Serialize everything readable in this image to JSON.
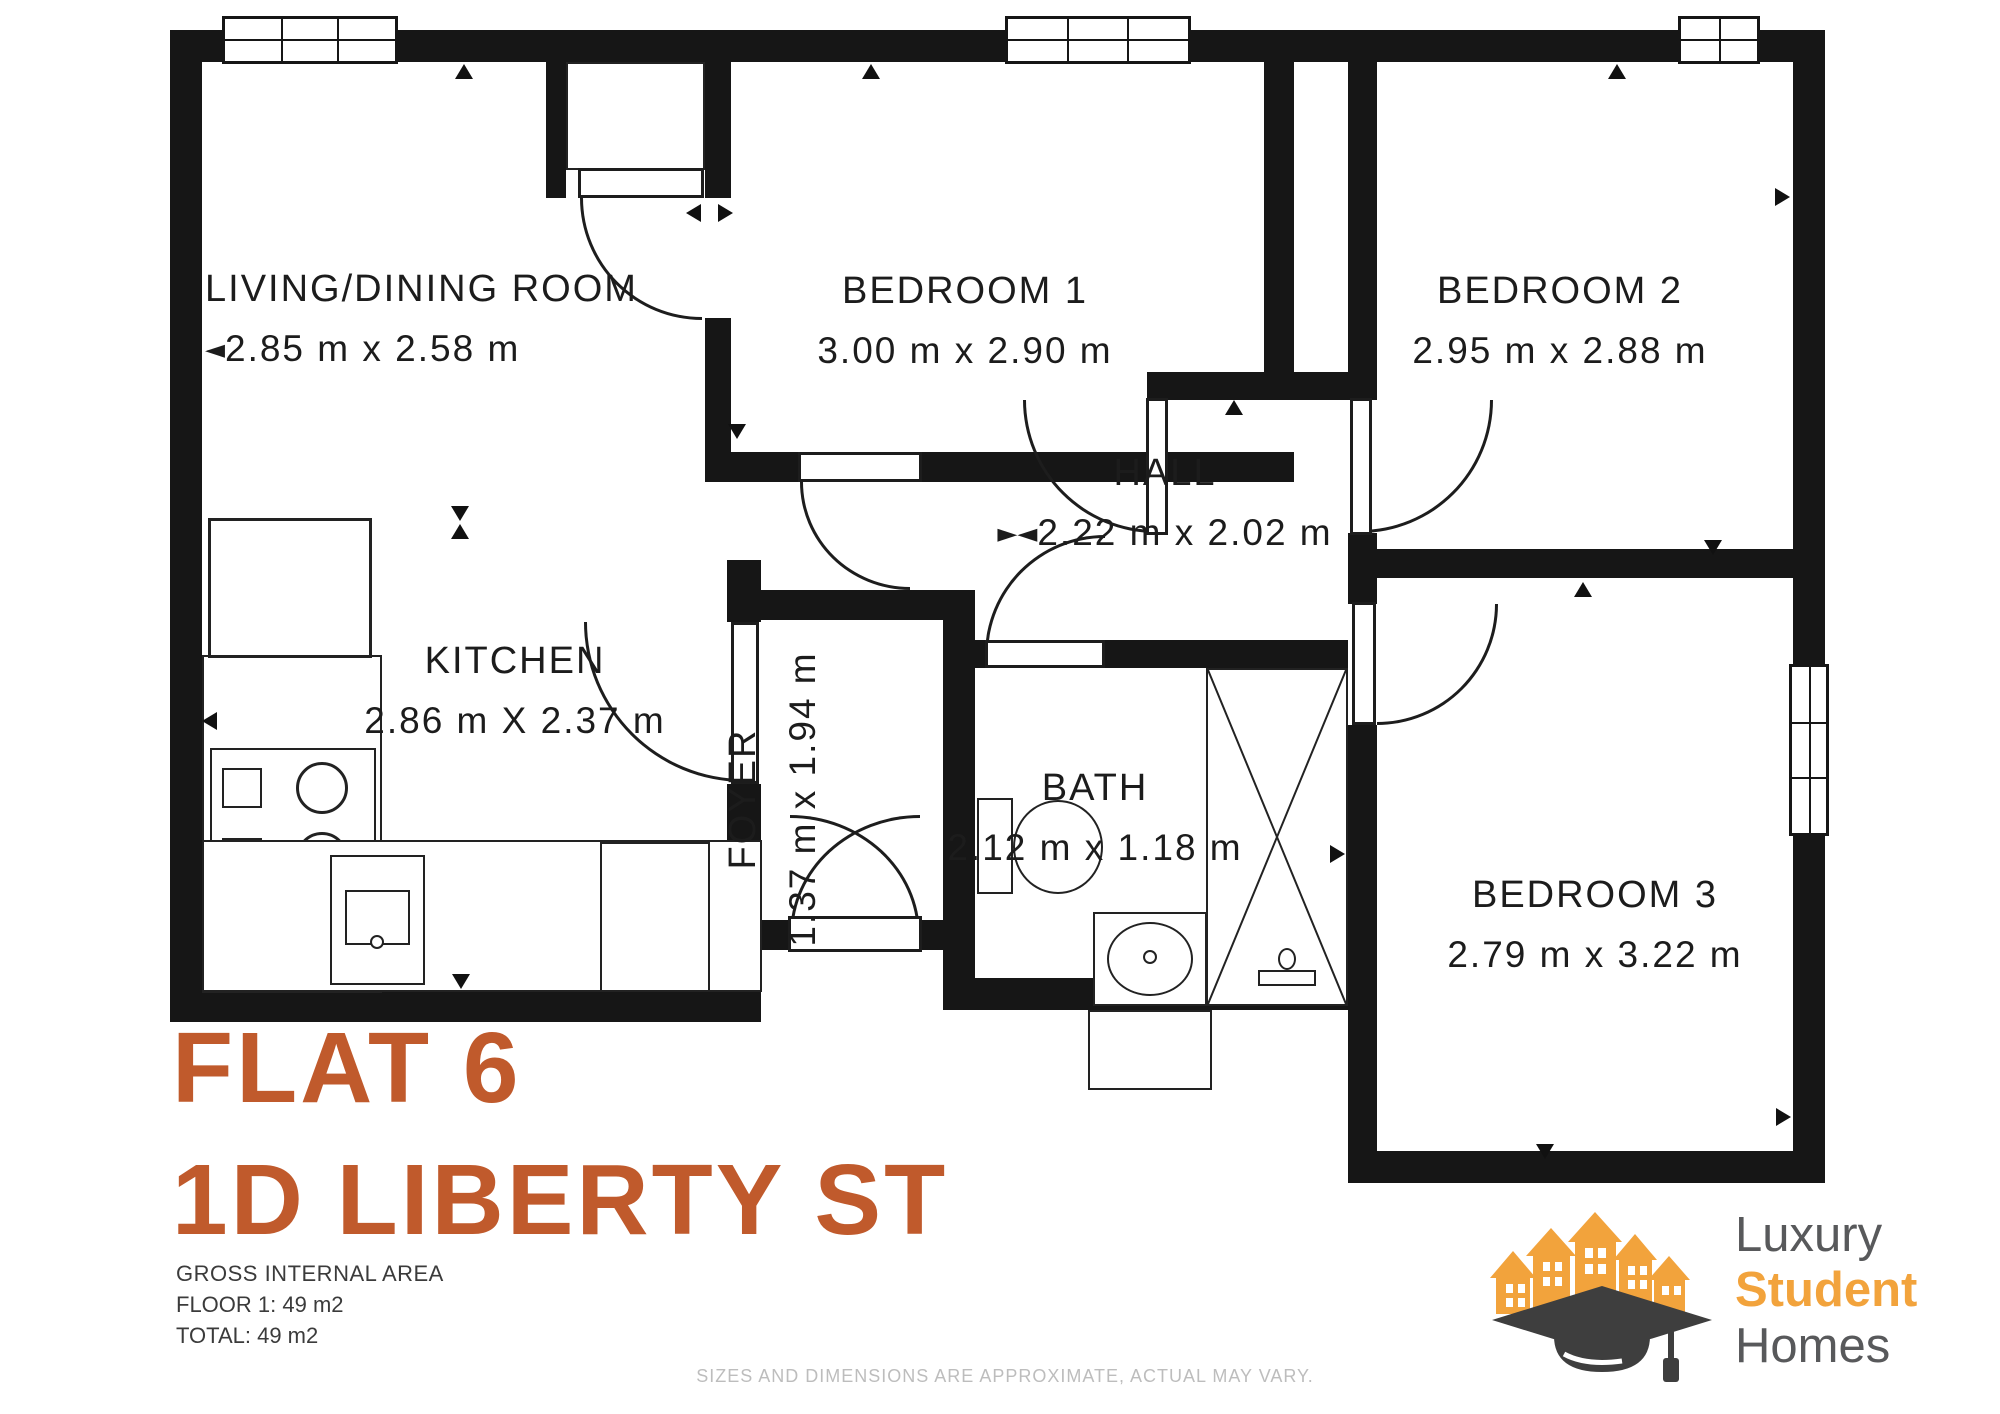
{
  "plan": {
    "rooms": [
      {
        "name": "LIVING/DINING ROOM",
        "dims": "2.85 m x 2.58 m",
        "marker": "◄"
      },
      {
        "name": "BEDROOM 1",
        "dims": "3.00 m x 2.90 m",
        "marker": ""
      },
      {
        "name": "BEDROOM 2",
        "dims": "2.95 m x 2.88 m",
        "marker": ""
      },
      {
        "name": "KITCHEN",
        "dims": "2.86 m X 2.37 m",
        "marker": ""
      },
      {
        "name": "FOYER",
        "dims": "1.37 m x 1.94 m",
        "marker": ""
      },
      {
        "name": "HALL",
        "dims": "2.22 m x 2.02 m",
        "marker": "►◄"
      },
      {
        "name": "BATH",
        "dims": "2.12 m x 1.18 m",
        "marker": ""
      },
      {
        "name": "BEDROOM 3",
        "dims": "2.79 m x 3.22 m",
        "marker": ""
      }
    ]
  },
  "title": {
    "line1": "FLAT 6",
    "line2": "1D LIBERTY ST"
  },
  "area_summary": {
    "heading": "GROSS INTERNAL AREA",
    "floor1": "FLOOR 1: 49 m2",
    "total": "TOTAL: 49 m2"
  },
  "footer": {
    "disclaimer": "SIZES AND DIMENSIONS ARE APPROXIMATE, ACTUAL MAY VARY."
  },
  "logo": {
    "word1": "Luxury",
    "word2": "Student",
    "word3": "Homes"
  },
  "colors": {
    "title": "#c05a2c",
    "logo_accent": "#f2a33c",
    "logo_text": "#58595b",
    "wall": "#161616"
  }
}
